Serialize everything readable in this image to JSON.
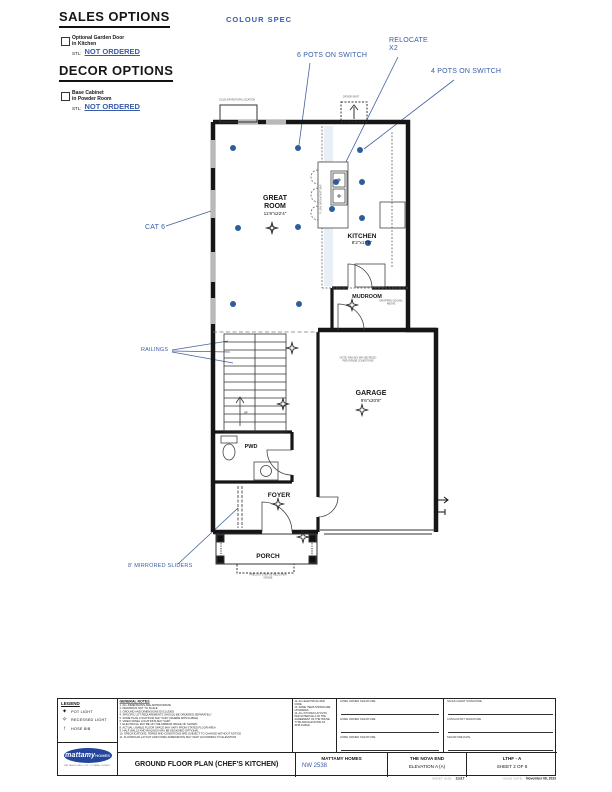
{
  "colors": {
    "annotation_blue": "#3a5ca8",
    "pot_light_blue": "#2d5d9f",
    "wall_black": "#161616",
    "logo_blue": "#24459c"
  },
  "options_panel": {
    "sales_heading": "SALES OPTIONS",
    "sales_item_line1": "Optional Garden Door",
    "sales_item_line2": "in Kitchen",
    "sales_stl_label": "STL:",
    "sales_status": "NOT ORDERED",
    "decor_heading": "DECOR OPTIONS",
    "decor_item_line1": "Base Cabinet",
    "decor_item_line2": "in Powder Room",
    "decor_stl_label": "STL:",
    "decor_status": "NOT ORDERED"
  },
  "colour_spec": "COLOUR SPEC",
  "annotations": {
    "pots6": "6 POTS ON SWITCH",
    "relocate1": "RELOCATE",
    "relocate2": "X2",
    "pots4": "4 POTS ON SWITCH",
    "cat6": "CAT 6",
    "railings": "RAILINGS",
    "mirrored_sliders": "8' MIRRORED SLIDERS"
  },
  "rooms": {
    "great_room_1": "GREAT",
    "great_room_2": "ROOM",
    "great_room_dims": "11'9\"x22'4\"",
    "kitchen": "KITCHEN",
    "kitchen_dims": "8'2\"x17'6\"",
    "mudroom": "MUDROOM",
    "garage": "GARAGE",
    "garage_dims": "9'6\"x20'8\"",
    "pwd": "PWD",
    "foyer": "FOYER",
    "porch": "PORCH"
  },
  "plan_captions": {
    "top_left": "COLD AIR RETURN LOCATION",
    "vent": "DRYER VENT",
    "island": "FLUSH BREAKFAST BAR",
    "stairs_up": "UP",
    "mudroom_note": "DROPPED CEILING ABOVE",
    "garage_note": "NOTE: RAILING MAY BE REQ'D PER GRADE CONDITIONS",
    "porch_note": "PRECAST STEP AS REQ'D PER GRADE"
  },
  "titleblock": {
    "legend": {
      "heading": "LEGEND",
      "items": [
        {
          "icon": "✦",
          "label": "POT LIGHT"
        },
        {
          "icon": "✧",
          "label": "RECESSED LIGHT"
        },
        {
          "icon": "↑",
          "label": "HOSE BIB"
        }
      ]
    },
    "general_notes": {
      "heading": "GENERAL NOTES",
      "lines": [
        "1. ALL DIMENSIONS ARE APPROXIMATE",
        "2. DRAWINGS NOT TO SCALE",
        "3. GROUND AND DIMENSIONS EXCLUDED",
        "4. SPECIFIC LOT REQUIREMENTS SHOULD BE ORDERED SEPARATELY",
        "5. SOME PLAN LOCATIONS MAY VARY (WHERE APPLICABLE)",
        "6. VIDEO PANEL LOCATIONS MAY VARY",
        "7. ELECTRICAL MAY BE ON THE MIRROR IMAGE OF SHOWN",
        "8. ACTUAL USABLE FLOOR SPACE MAY VARY FROM STATED FLOOR AREA",
        "9. HALF WALLS AND RAILINGS MAY BE DESIGNED OPTIONAL",
        "10. SPECIFICATIONS, TERMS AND CONDITIONS ARE SUBJECT TO CHANGE WITHOUT NOTICE",
        "11. FLOORPLAN LAYOUT AND FINISH DIMENSIONS MAY VARY ACCORDING TO ELEVATION"
      ]
    },
    "side_notes": {
      "lines": [
        "12. ALL ELECTRICAL PER CODE",
        "13. SOME ITEMS SHOWN ARE UPGRADES",
        "14. ALL KITCHEN LAYOUTS PER SCHEDULE A OF THE AGREEMENT OF THE HOUSE TYPE AND ELEVATION AS APPLICABLE"
      ]
    },
    "signatures": {
      "home_owner": "HOME OWNER SIGNATURE",
      "sales_agent": "SALES AGENT SIGNATURE",
      "consultant": "CONSULTANT SIGNATURE",
      "date": "SIGNATURE DATE"
    },
    "drawing_title": "GROUND FLOOR PLAN (CHEF'S KITCHEN)",
    "builder": "MATTAMY HOMES",
    "plan_number": "NW 2538",
    "model": "THE NOVA END",
    "elevation": "ELEVATION A (A)",
    "series": "LTHF - A",
    "sheet": "SHEET 2 OF 6",
    "sheet_size_label": "SHEET SIZE",
    "sheet_size": "11x17",
    "issue_date_label": "ISSUE DATE",
    "issue_date": "November 06, 2023",
    "logo_text": "mattamy",
    "logo_sub": "HOMES",
    "logo_lines": "MATTAMYHOMES.COM · OTTAWA, ONTARIO"
  }
}
